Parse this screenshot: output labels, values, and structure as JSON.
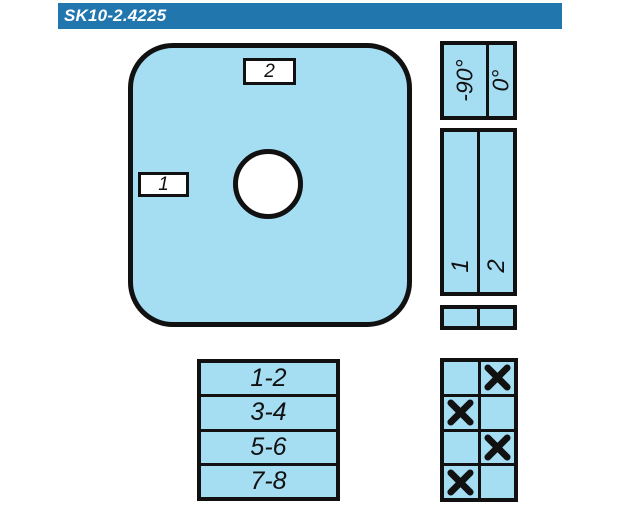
{
  "header": {
    "title": "SK10-2.4225",
    "bg_color": "#2176ae",
    "text_color": "#ffffff"
  },
  "colors": {
    "fill_light_blue": "#a5ddf3",
    "line_black": "#111111",
    "background": "#ffffff"
  },
  "switch_face": {
    "top_label": "2",
    "left_label": "1"
  },
  "angle_table": {
    "columns": [
      "-90°",
      "0°"
    ]
  },
  "position_table": {
    "columns": [
      "1",
      "2"
    ]
  },
  "terminal_table": {
    "rows": [
      "1-2",
      "3-4",
      "5-6",
      "7-8"
    ]
  },
  "contact_table": {
    "mark": "X",
    "rows": [
      [
        false,
        true
      ],
      [
        true,
        false
      ],
      [
        false,
        true
      ],
      [
        true,
        false
      ]
    ]
  }
}
